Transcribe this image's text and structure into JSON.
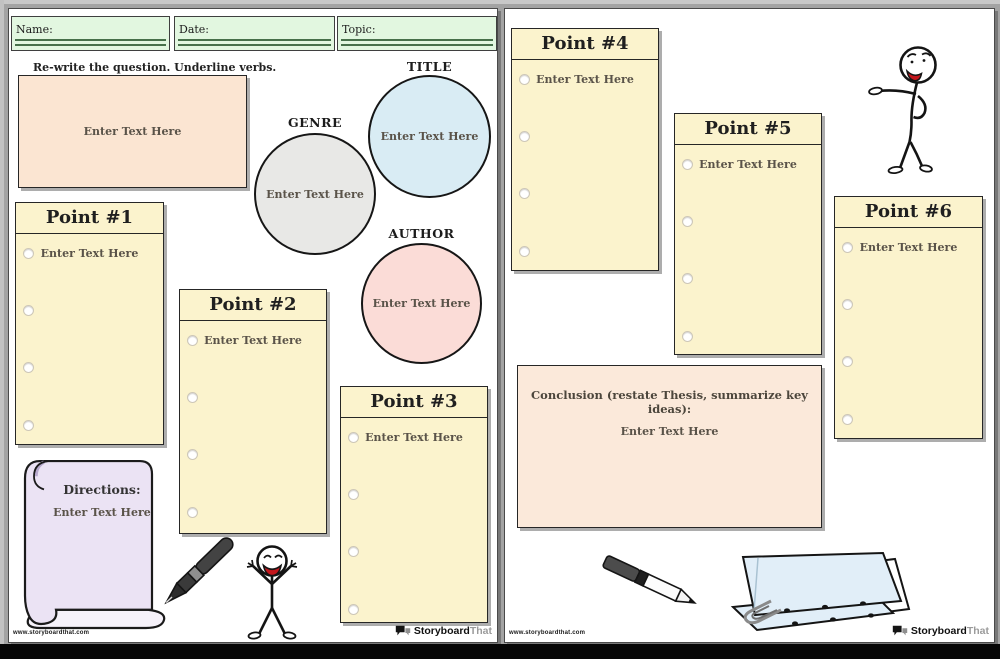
{
  "brand": {
    "watermark": "www.storyboardthat.com",
    "logo_primary": "Storyboard",
    "logo_secondary": "That"
  },
  "left_page": {
    "fields": [
      {
        "label": "Name:"
      },
      {
        "label": "Date:"
      },
      {
        "label": "Topic:"
      }
    ],
    "instruction": "Re-write the question. Underline verbs.",
    "rewrite_box": {
      "placeholder": "Enter Text Here"
    },
    "circles": [
      {
        "label": "TITLE",
        "placeholder": "Enter Text Here"
      },
      {
        "label": "GENRE",
        "placeholder": "Enter Text Here"
      },
      {
        "label": "AUTHOR",
        "placeholder": "Enter Text Here"
      }
    ],
    "points": [
      {
        "title": "Point #1",
        "placeholder": "Enter Text Here"
      },
      {
        "title": "Point #2",
        "placeholder": "Enter Text Here"
      },
      {
        "title": "Point #3",
        "placeholder": "Enter Text Here"
      }
    ],
    "directions": {
      "title": "Directions:",
      "placeholder": "Enter Text Here"
    }
  },
  "right_page": {
    "points": [
      {
        "title": "Point #4",
        "placeholder": "Enter Text Here"
      },
      {
        "title": "Point #5",
        "placeholder": "Enter Text Here"
      },
      {
        "title": "Point #6",
        "placeholder": "Enter Text Here"
      }
    ],
    "conclusion": {
      "label": "Conclusion (restate Thesis, summarize key ideas):",
      "placeholder": "Enter Text Here"
    }
  },
  "colors": {
    "background": "#a3a3a3",
    "page": "#ffffff",
    "field_fill": "#e2f7e0",
    "field_underline": "#47704a",
    "point_box_fill": "#fbf3cd",
    "rewrite_box_fill": "#fbe5d2",
    "conclusion_fill": "#fbe9da",
    "title_circle_fill": "#d9ecf4",
    "genre_circle_fill": "#e8e8e6",
    "author_circle_fill": "#fbdcd7",
    "scroll_fill": "#ebe3f4",
    "paper_fill": "#e1eef8",
    "mouth_red": "#c3161c"
  }
}
